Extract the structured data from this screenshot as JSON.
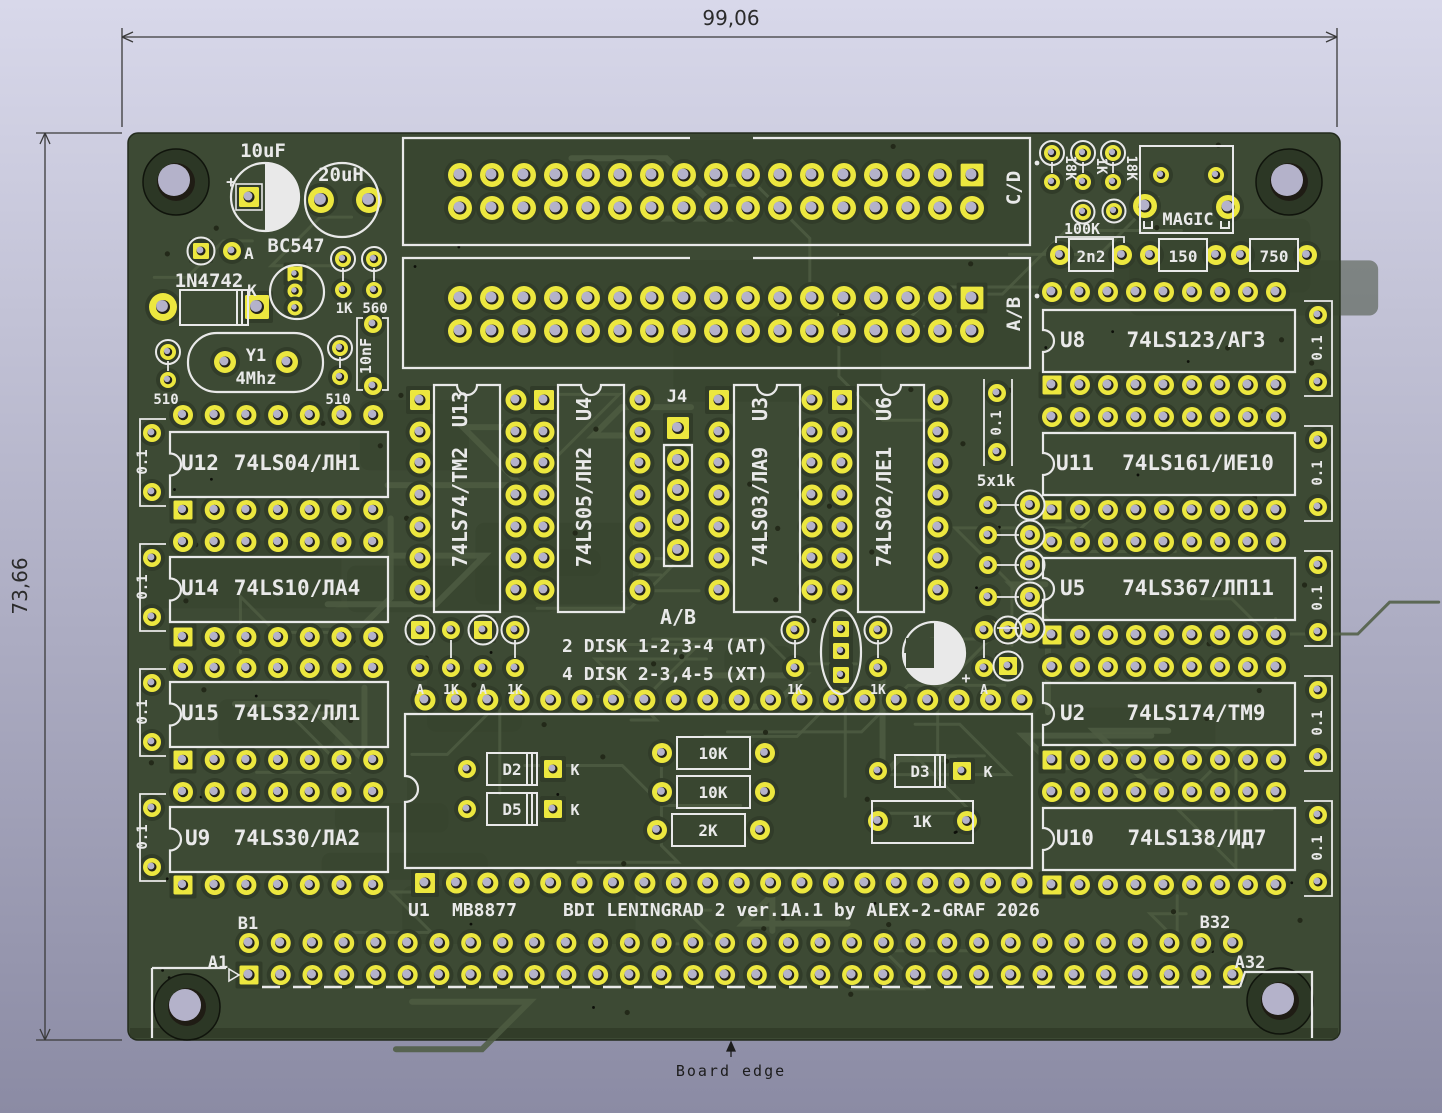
{
  "dimensions": {
    "width": "99,06",
    "height": "73,66"
  },
  "board_note": {
    "edge_label": "Board edge"
  },
  "title_block": {
    "u1_ref": "U1",
    "u1_part": "MB8877",
    "title": "BDI LENINGRAD 2 ver.1A.1 by ALEX-2-GRAF 2026"
  },
  "connectors": {
    "cd": "C/D",
    "ab": "A/B",
    "j4": "J4",
    "b1": "B1",
    "a1": "A1",
    "b32": "B32",
    "a32": "A32"
  },
  "jumper_note": {
    "header": "A/B",
    "line_at": "2 DISK 1-2,3-4 (AT)",
    "line_xt": "4 DISK 2-3,4-5 (XT)"
  },
  "ics": {
    "u12": {
      "ref": "U12",
      "part": "74LS04/ЛН1"
    },
    "u14": {
      "ref": "U14",
      "part": "74LS10/ЛА4"
    },
    "u15": {
      "ref": "U15",
      "part": "74LS32/ЛЛ1"
    },
    "u9": {
      "ref": "U9",
      "part": "74LS30/ЛА2"
    },
    "u8": {
      "ref": "U8",
      "part": "74LS123/АГ3"
    },
    "u11": {
      "ref": "U11",
      "part": "74LS161/ИЕ10"
    },
    "u5": {
      "ref": "U5",
      "part": "74LS367/ЛП11"
    },
    "u2": {
      "ref": "U2",
      "part": "74LS174/ТМ9"
    },
    "u10": {
      "ref": "U10",
      "part": "74LS138/ИД7"
    },
    "u13": {
      "ref": "U13",
      "part": "74LS74/ТМ2"
    },
    "u4": {
      "ref": "U4",
      "part": "74LS05/ЛН2"
    },
    "u3": {
      "ref": "U3",
      "part": "74LS03/ЛА9"
    },
    "u6": {
      "ref": "U6",
      "part": "74LS02/ЛЕ1"
    }
  },
  "parts": {
    "c_10uf": "10uF",
    "plus": "+",
    "l_20uh": "20uH",
    "q_bc547": "BC547",
    "a": "A",
    "d_1n4742": "1N4742",
    "k": "K",
    "y1_ref": "Y1",
    "y1_val": "4Mhz",
    "r510": "510",
    "r1k": "1K",
    "r560": "560",
    "c_10nf": "10nF",
    "r18k": "18K",
    "r100k": "100K",
    "magic": "MAGIC",
    "c_2n2": "2n2",
    "r150": "150",
    "r750": "750",
    "rn_5x1k": "5x1k",
    "c01": "0.1",
    "d2": "D2",
    "d5": "D5",
    "d3": "D3",
    "r10k": "10K",
    "r2k": "2K"
  },
  "colors": {
    "background_top": "#d6d6e9",
    "background_bottom": "#8d8da6",
    "board_green": "#3d4a34",
    "pour_dark": "#35412c",
    "trace_light": "#4e5c42",
    "pad_yellow": "#ece73f",
    "hole_lavender": "#b4b2ca",
    "silkscreen": "#e9e9e9"
  }
}
